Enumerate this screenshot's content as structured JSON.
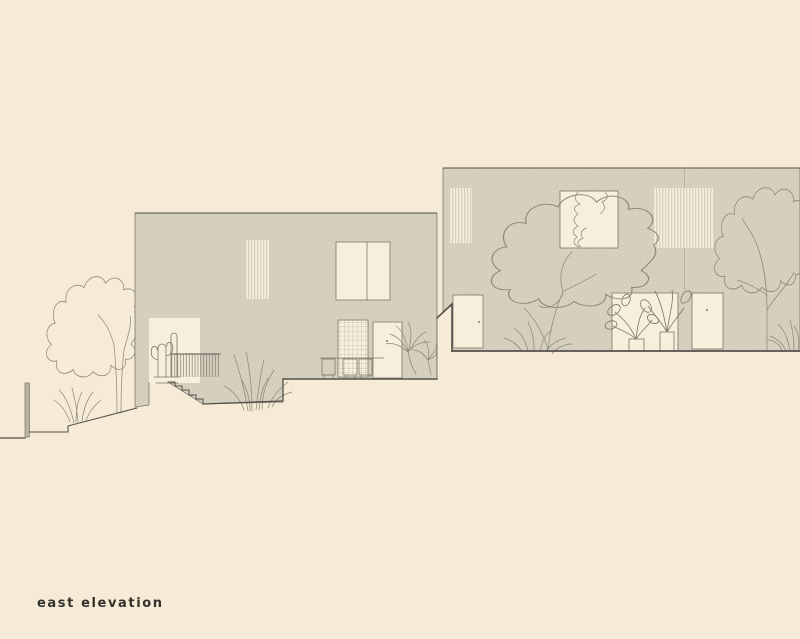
{
  "title": {
    "label": "east elevation"
  },
  "palette": {
    "bg": "#f5ebd7",
    "line_dark": "#55514a",
    "line_mid": "#7b766a",
    "line_light": "#aaa393",
    "plant_line": "#8f8a7a",
    "brick_base": "#d9d3c2",
    "brick_face": "#e9e3d2",
    "brick_gap": "#bdb7a6",
    "opening": "#f7eedb",
    "post_fill": "#b9b3a2",
    "text": "#32312b"
  },
  "drawing": {
    "type": "architectural-elevation",
    "buildings": [
      {
        "name": "left-building",
        "facade": "brick",
        "openings": [
          "louver-window",
          "double-casement-window",
          "garden-opening-with-cacti",
          "gridded-window",
          "entry-door"
        ],
        "features": [
          "stair-railing",
          "exterior-stairs",
          "terrace-edge",
          "patio-chairs",
          "palm-plant",
          "ornamental-grasses"
        ]
      },
      {
        "name": "right-building",
        "facade": "brick",
        "openings": [
          "louver-window-left",
          "square-window",
          "louver-window-right",
          "door-left",
          "planted-opening",
          "door-right"
        ],
        "features": [
          "center-tree-sketch",
          "right-tree-sketch",
          "corner-shrub",
          "potted-plants"
        ]
      }
    ],
    "site": [
      "sloping-ground-line",
      "retaining-post",
      "deciduous-tree",
      "garden-shrub",
      "level-change-wall"
    ]
  }
}
